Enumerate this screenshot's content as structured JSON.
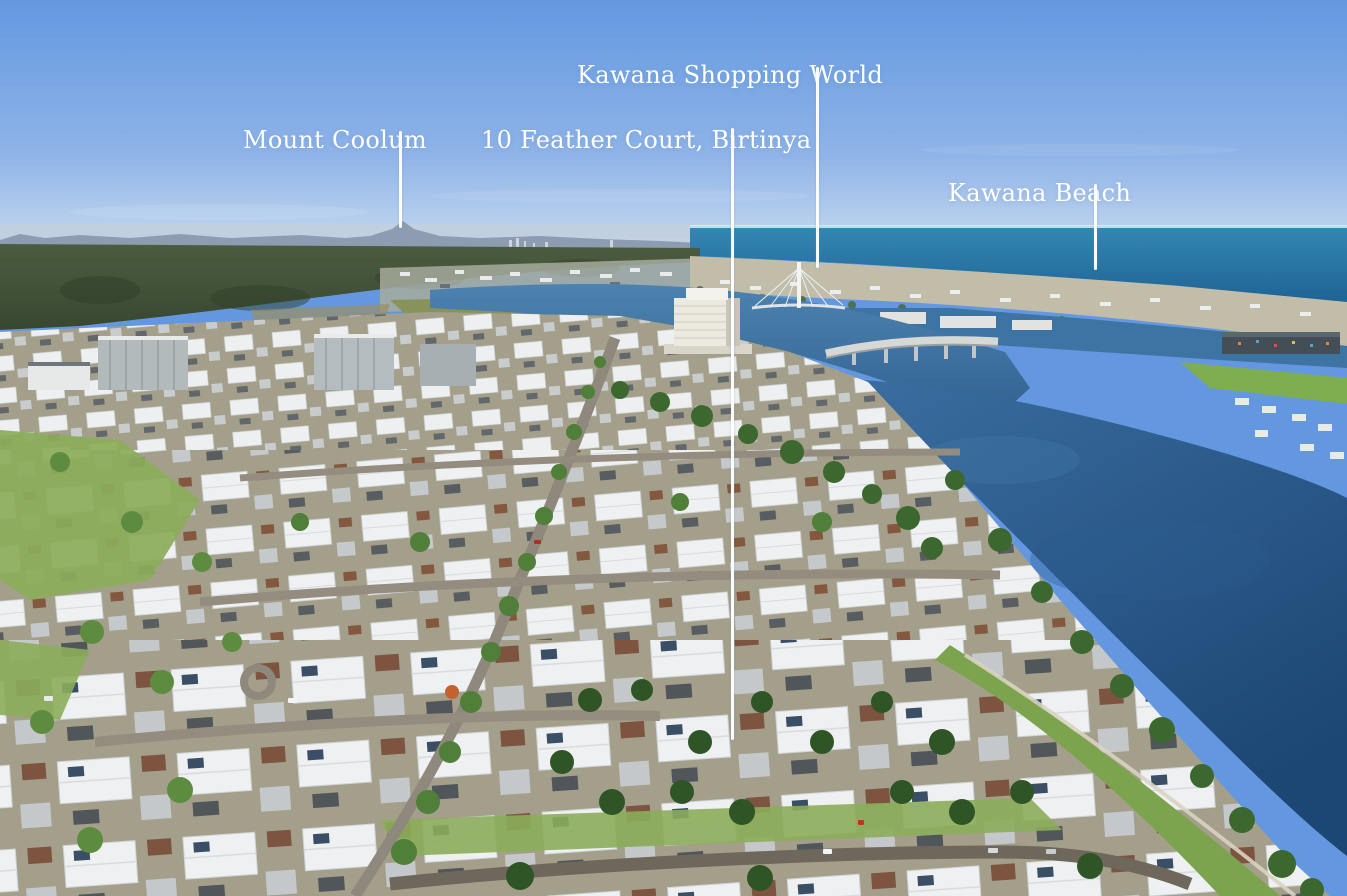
{
  "photo": {
    "type": "aerial-photograph",
    "annotation_color": "#ffffff",
    "colors": {
      "sky_top": "#6398e0",
      "sky_horizon": "#c9dbef",
      "ocean": "#1d6394",
      "waterway": "#3a6f9f",
      "lake": "#1c4673",
      "forest": "#44523a",
      "grass": "#7fae51",
      "roofs": "#eef0f1"
    }
  },
  "annotations": [
    {
      "id": "kawana-shopping-world",
      "label": "Kawana Shopping World"
    },
    {
      "id": "mount-coolum",
      "label": "Mount Coolum"
    },
    {
      "id": "feather-court",
      "label": "10 Feather Court, Birtinya"
    },
    {
      "id": "kawana-beach",
      "label": "Kawana Beach"
    }
  ]
}
